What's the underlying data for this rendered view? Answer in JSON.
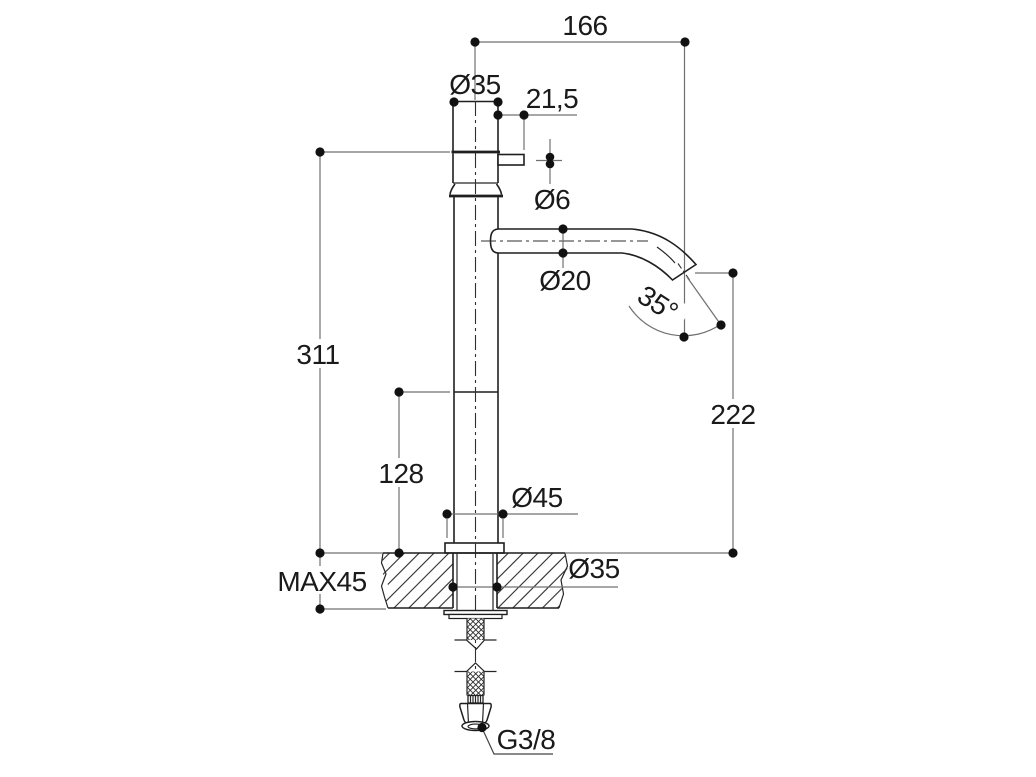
{
  "drawing": {
    "kind": "technical dimension drawing",
    "subject": "tall single-hole basin mixer tap, side elevation with installation dimensions",
    "colors": {
      "background": "#ffffff",
      "object_line": "#1f1f1f",
      "dimension_line": "#707070",
      "text": "#1a1a1a",
      "dot": "#111111"
    },
    "labels": {
      "spout_reach": "166",
      "body_diameter": "Ø35",
      "handle_length": "21,5",
      "handle_stem_diameter": "Ø6",
      "spout_tube_diameter": "Ø20",
      "spout_angle": "35°",
      "total_height": "311",
      "outlet_height": "222",
      "column_height": "128",
      "base_diameter": "Ø45",
      "max_deck_thickness": "MAX45",
      "hole_diameter": "Ø35",
      "supply_thread": "G3/8"
    }
  }
}
